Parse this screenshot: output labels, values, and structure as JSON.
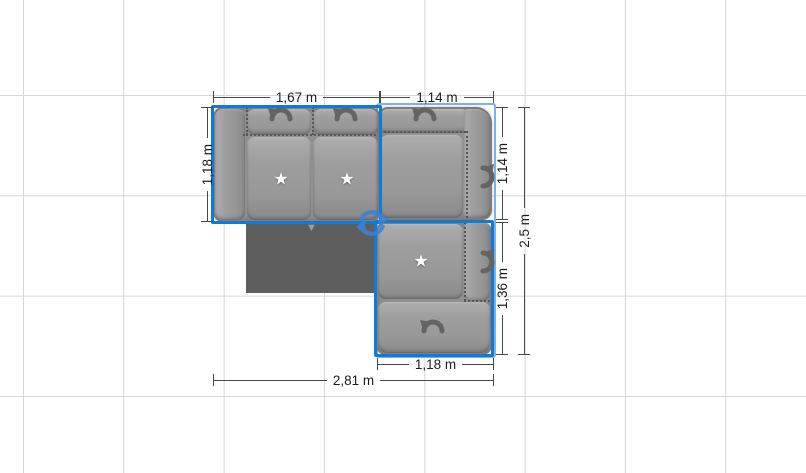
{
  "canvas": {
    "background_color": "#ffffff",
    "grid_line_color": "#d7d7d7"
  },
  "colors": {
    "module_selection_outline": "#107ad8",
    "group_selection_outline": "#7db2e8",
    "rotate_handle": "#3b82d5",
    "sofa_gray": "#9a9a9a",
    "table_gray": "#5e5e5e",
    "dimension_line": "#484848"
  },
  "icons": {
    "star": "★",
    "front_marker": "▼",
    "rotate_arrow": "curved-rotate-arrow",
    "group_rotate_handle": "circular-rotate-arrows"
  },
  "dimensions": {
    "top_left_width": "1,67 m",
    "top_right_width": "1,14 m",
    "left_height": "1,18 m",
    "right_upper_height": "1,14 m",
    "right_lower_height": "1,36 m",
    "right_total_height": "2,5 m",
    "bottom_right_width": "1,18 m",
    "total_width": "2,81 m"
  },
  "objects": {
    "sofa": {
      "kind": "L-shaped modular sofa, top view, selected"
    },
    "table": {
      "kind": "dark rectangular table"
    }
  }
}
